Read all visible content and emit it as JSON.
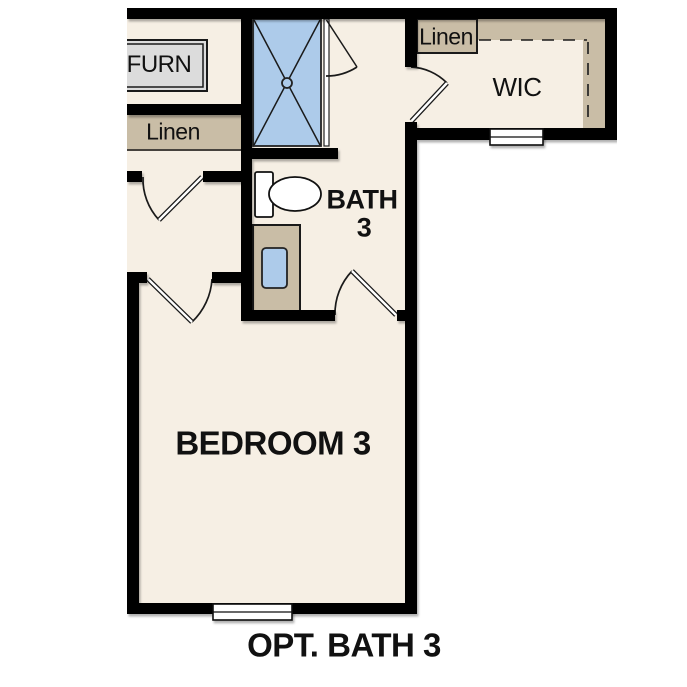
{
  "labels": {
    "furnace": "FURN",
    "linen_hall": "Linen",
    "linen_wic": "Linen",
    "wic": "WIC",
    "bath_line1": "BATH",
    "bath_line2": "3",
    "bedroom": "BEDROOM 3",
    "caption": "OPT. BATH 3"
  },
  "colors": {
    "floor": "#f6efe4",
    "wall": "#000000",
    "casework_tan": "#c9bda6",
    "fixture_blue": "#adcbea",
    "furnace_gray": "#dcdcdc",
    "window_white": "#ffffff",
    "line": "#1a1a1a",
    "text": "#111111",
    "page_bg": "#ffffff"
  },
  "fixtures": [
    "shower-with-glass-door",
    "toilet",
    "vanity-with-sink",
    "furnace-unit",
    "closet-shelf-dashed-rod",
    "window-bedroom",
    "window-wic",
    "door-hall",
    "door-bedroom",
    "door-bath",
    "door-wic"
  ]
}
